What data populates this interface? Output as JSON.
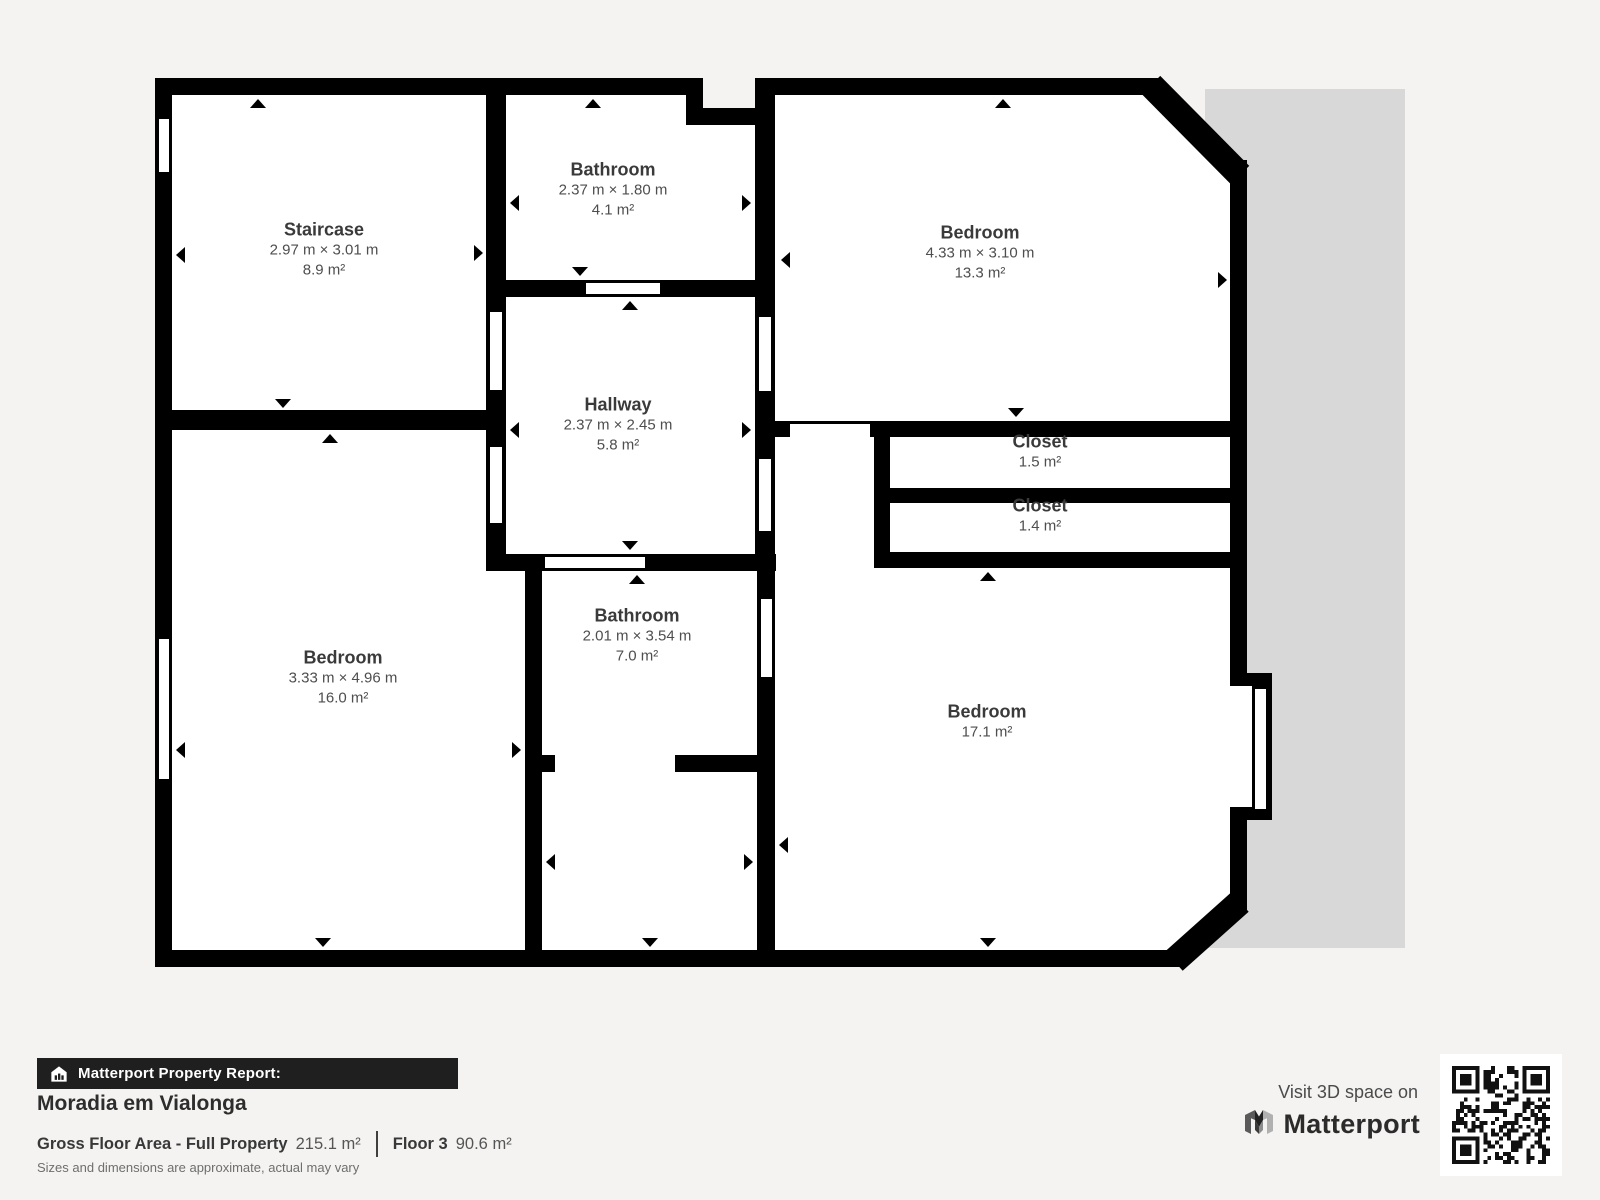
{
  "floorplan": {
    "rooms": [
      {
        "name": "Staircase",
        "dims": "2.97 m × 3.01 m",
        "area": "8.9 m²"
      },
      {
        "name": "Bathroom",
        "dims": "2.37 m × 1.80 m",
        "area": "4.1 m²"
      },
      {
        "name": "Bedroom",
        "dims": "4.33 m × 3.10 m",
        "area": "13.3 m²"
      },
      {
        "name": "Hallway",
        "dims": "2.37 m × 2.45 m",
        "area": "5.8 m²"
      },
      {
        "name": "Closet",
        "area": "1.5 m²"
      },
      {
        "name": "Closet",
        "area": "1.4 m²"
      },
      {
        "name": "Bedroom",
        "dims": "3.33 m × 4.96 m",
        "area": "16.0 m²"
      },
      {
        "name": "Bathroom",
        "dims": "2.01 m × 3.54 m",
        "area": "7.0 m²"
      },
      {
        "name": "Bedroom",
        "area": "17.1 m²"
      }
    ]
  },
  "footer": {
    "report_label": "Matterport Property Report:",
    "property_name": "Moradia em Vialonga",
    "gfa_label": "Gross Floor Area - Full Property",
    "gfa_value": "215.1 m²",
    "floor_label": "Floor 3",
    "floor_value": "90.6 m²",
    "disclaimer": "Sizes and dimensions are approximate, actual may vary"
  },
  "promo": {
    "visit_text": "Visit 3D space on",
    "brand": "Matterport"
  },
  "colors": {
    "wall": "#000000",
    "adjacent_area": "#d8d8d8",
    "page_bg": "#f4f3f1",
    "accent_bar": "#1f1f1f"
  }
}
